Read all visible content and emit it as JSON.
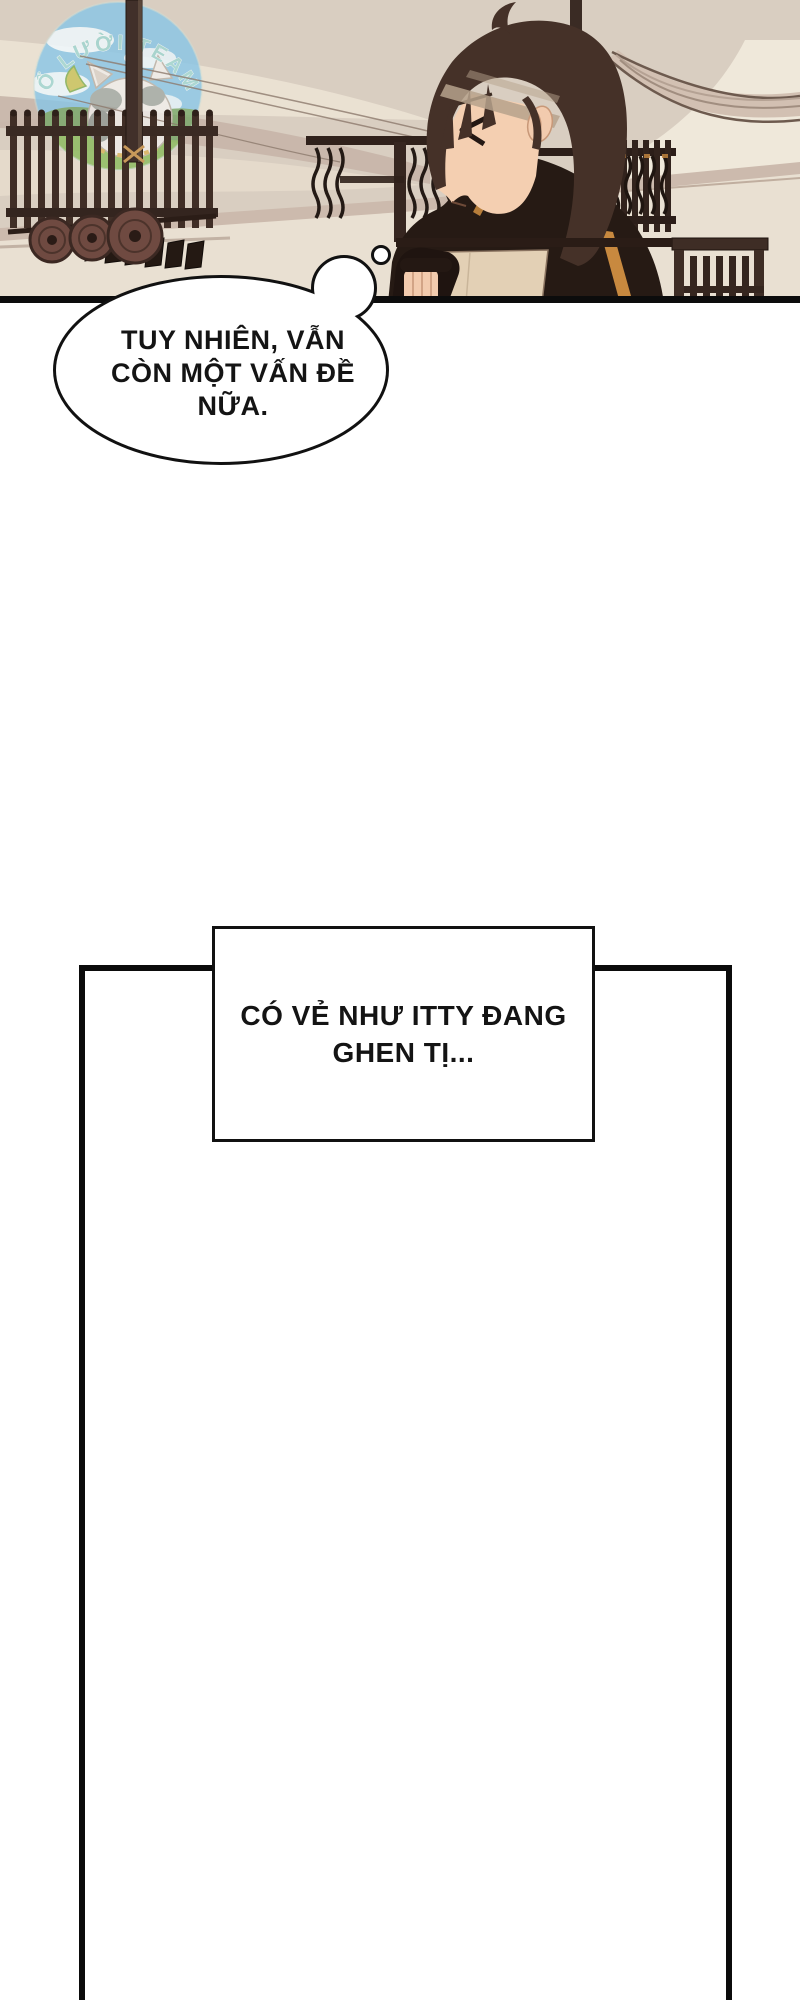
{
  "comic": {
    "watermark_text": "Ổ LƯỜI TEAM",
    "thought_bubble": {
      "line1": "TUY NHIÊN, VẪN",
      "line2": "CÒN MỘT VẤN ĐỀ",
      "line3": "NỮA."
    },
    "caption": {
      "line1": "CÓ VẺ NHƯ ITTY ĐANG",
      "line2": "GHEN TỊ..."
    },
    "palette": {
      "panel_bg": "#d9cec1",
      "cream_swoosh": "#ebe2d3",
      "mauve_band": "#c6b5a8",
      "floor_light": "#e9e0d2",
      "wood_dark": "#3a2a23",
      "shield_brown": "#6f4a41",
      "hair_brown": "#453128",
      "skin": "#f4cfb1",
      "jacket_dark": "#261a14",
      "accent_orange": "#c8893f",
      "sky_blue": "#8ac6e6",
      "grass_green": "#8cbb5e",
      "team_text_teal": "#9fd6d2",
      "ink_black": "#0c0c0c"
    }
  }
}
